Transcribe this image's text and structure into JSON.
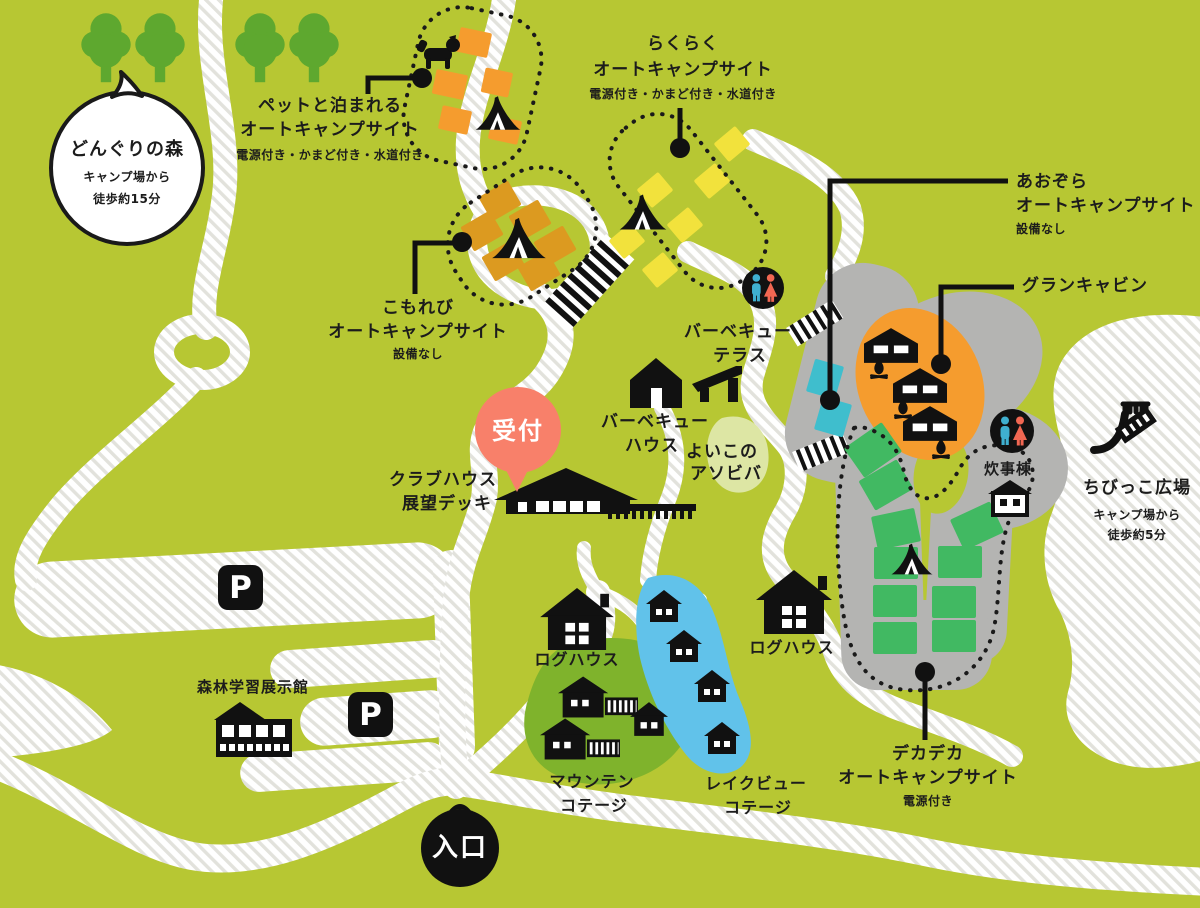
{
  "map_title": "キャンプ場マップ",
  "areas": {
    "donguri": {
      "name": "どんぐりの森",
      "sub1": "キャンプ場から",
      "sub2": "徒歩約15分"
    },
    "pet": {
      "line1": "ペットと泊まれる",
      "line2": "オートキャンプサイト",
      "amenities": "電源付き・かまど付き・水道付き"
    },
    "rakuraku": {
      "line1": "らくらく",
      "line2": "オートキャンプサイト",
      "amenities": "電源付き・かまど付き・水道付き"
    },
    "komorebi": {
      "line1": "こもれび",
      "line2": "オートキャンプサイト",
      "amenities": "設備なし"
    },
    "aozora": {
      "line1": "あおぞら",
      "line2": "オートキャンプサイト",
      "amenities": "設備なし"
    },
    "gran_cabin": {
      "name": "グランキャビン"
    },
    "dekadeka": {
      "line1": "デカデカ",
      "line2": "オートキャンプサイト",
      "amenities": "電源付き"
    },
    "chibikko": {
      "name": "ちびっこ広場",
      "sub1": "キャンプ場から",
      "sub2": "徒歩約5分"
    },
    "reception": {
      "name": "受付"
    },
    "clubhouse": {
      "line1": "クラブハウス",
      "line2": "展望デッキ"
    },
    "bbq_house": {
      "line1": "バーベキュー",
      "line2": "ハウス"
    },
    "bbq_terrace": {
      "line1": "バーベキュー",
      "line2": "テラス"
    },
    "yoiko": {
      "line1": "よいこの",
      "line2": "アソビバ"
    },
    "suijito": {
      "name": "炊事棟"
    },
    "log_house_left": {
      "name": "ログハウス"
    },
    "log_house_right": {
      "name": "ログハウス"
    },
    "mountain_cottage": {
      "line1": "マウンテン",
      "line2": "コテージ"
    },
    "lakeview_cottage": {
      "line1": "レイクビュー",
      "line2": "コテージ"
    },
    "forest_museum": {
      "name": "森林学習展示館"
    },
    "entrance": {
      "name": "入口"
    },
    "parking": {
      "label": "P"
    }
  },
  "colors": {
    "background": "#b7c733",
    "tree_green": "#5ea82f",
    "site_orange": "#f59c2e",
    "site_amber": "#dc9a20",
    "site_yellow": "#f2e23c",
    "site_green": "#41b962",
    "site_teal": "#3fbecd",
    "lake_blue": "#61c2ea",
    "cottage_blob_green": "#7fb32c",
    "gray_area": "#b4b4b2",
    "pale_blob": "#dde6a4",
    "reception_salmon": "#f8806a",
    "restroom_man_blue": "#3fb0d0",
    "restroom_woman_red": "#f16752",
    "road_white": "#ffffff",
    "road_stripe": "#e2e2dc",
    "outline_black": "#1a1a1a"
  }
}
